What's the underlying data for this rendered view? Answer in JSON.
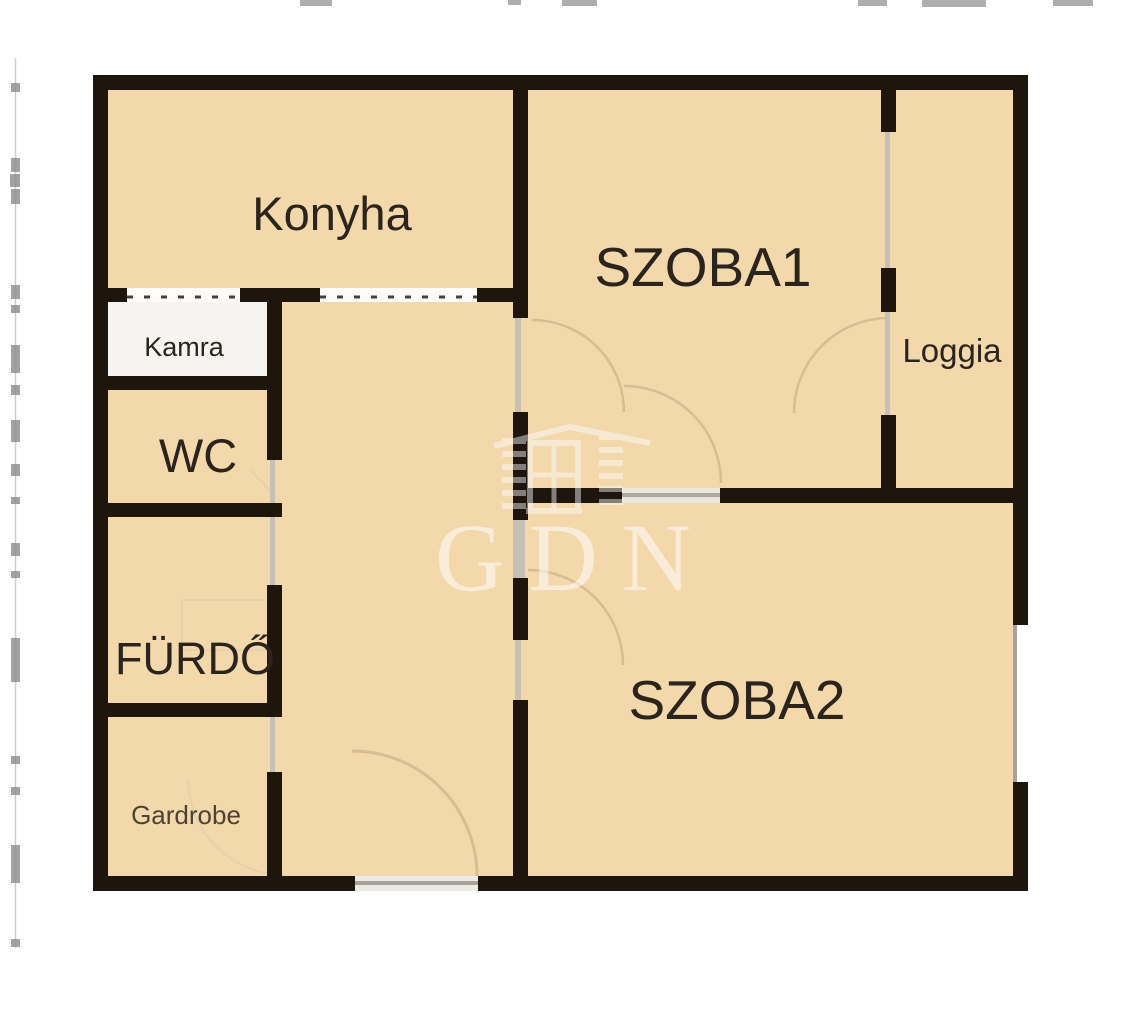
{
  "plan": {
    "type": "apartment-floor-plan",
    "watermark": "GDN",
    "rooms": {
      "konyha": {
        "label": "Konyha"
      },
      "kamra": {
        "label": "Kamra"
      },
      "wc": {
        "label": "WC"
      },
      "furdo": {
        "label": "FÜRDŐ"
      },
      "gardrobe": {
        "label": "Gardrobe"
      },
      "szoba1": {
        "label": "SZOBA1"
      },
      "szoba2": {
        "label": "SZOBA2"
      },
      "loggia": {
        "label": "Loggia"
      }
    },
    "colors": {
      "room_fill": "#f2d8ab",
      "pantry_fill": "#f5f4f1",
      "wall": "#1e150d",
      "door_line": "#c6c0b7",
      "door_arc": "#d9bd92",
      "faint_fixture": "#e6d2ab",
      "label_text": "#2b241c",
      "gardrobe_text": "#4e4232",
      "watermark": "#ffffff",
      "ruler": "#8c8c8c"
    }
  }
}
